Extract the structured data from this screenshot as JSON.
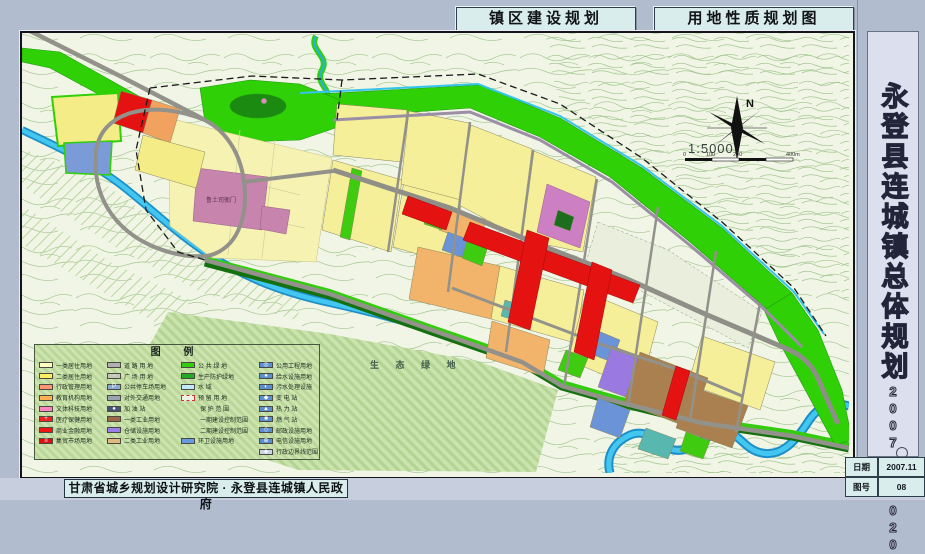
{
  "titles": {
    "left": "镇区建设规划",
    "right": "用地性质规划图"
  },
  "sidebar": {
    "title": "永登县连城镇总体规划",
    "period": "2007——2020"
  },
  "footer": {
    "credit": "甘肃省城乡规划设计研究院 · 永登县连城镇人民政府",
    "date_label": "日期",
    "date_value": "2007.11",
    "sheet_label": "图号",
    "sheet_value": "08"
  },
  "map": {
    "eco_label": "生 态 绿 地",
    "heritage_label": "鲁土司衙门",
    "north_label": "N",
    "scale_label": "1:5000",
    "scale_tick_0": "0",
    "scale_tick_1": "100",
    "scale_tick_2": "200",
    "scale_tick_3": "400m"
  },
  "colors": {
    "page_bg": "#b2bccf",
    "panel_cyan": "#d9edec",
    "map_bg": "#f1f5e6",
    "green_open": "#2fd005",
    "water": "#43c7f0",
    "residential": "#f6ef9a",
    "commercial_red": "#e51212",
    "industry_brown": "#ab8050",
    "storage_purple": "#9a7ae0",
    "admin_orange": "#f2b36a",
    "heritage_pink": "#c784ad",
    "utility_blue": "#5b8fd0"
  },
  "legend": {
    "title": "图    例",
    "columns": [
      [
        {
          "label": "一类居住用地",
          "color": "#ffffc2"
        },
        {
          "label": "二类居住用地",
          "color": "#fdf060"
        },
        {
          "label": "行政管理用地",
          "color": "#ff9470"
        },
        {
          "label": "教育机构用地",
          "color": "#ffb055"
        },
        {
          "label": "文体科技用地",
          "color": "#ff85c0"
        },
        {
          "label": "医疗保健用地",
          "color": "#ee2020",
          "icon": "+"
        },
        {
          "label": "商业金融用地",
          "color": "#ee1515"
        },
        {
          "label": "集贸市场用地",
          "color": "#dd1111",
          "icon": "≡"
        }
      ],
      [
        {
          "label": "道 路 用 地",
          "color": "#b0b0b0"
        },
        {
          "label": "广 场 用 地",
          "color": "#c2cab6",
          "icon": "∙∙"
        },
        {
          "label": "公共停车场用地",
          "color": "#88aacc",
          "icon": "P"
        },
        {
          "label": "对外交通用地",
          "color": "#9aa4b0"
        },
        {
          "label": "加 油 站",
          "color": "#445577",
          "icon": "●"
        },
        {
          "label": "一类工业用地",
          "color": "#9a6a48"
        },
        {
          "label": "仓储设施用地",
          "color": "#9b7fe8"
        },
        {
          "label": "二类工业用地",
          "color": "#dfb97f"
        }
      ],
      [
        {
          "label": "公 共 绿 地",
          "color": "#33cc11"
        },
        {
          "label": "生产防护绿地",
          "color": "#22aa22"
        },
        {
          "label": "水    域",
          "color": "#bfe8f8",
          "icon": "~"
        },
        {
          "label": "预 留 用 地",
          "color": "#eef2e4",
          "border": "dashed"
        },
        {
          "label": "保 护 范 围",
          "line": "dashdot",
          "lineColor": "#cc2222"
        },
        {
          "label": "一期建设控制范围",
          "line": "dash",
          "lineColor": "#cc2222"
        },
        {
          "label": "二期建设控制范围",
          "line": "dash",
          "lineColor": "#2255cc"
        },
        {
          "label": "环卫设施用地",
          "color": "#6699dd"
        }
      ],
      [
        {
          "label": "公用工程用地",
          "color": "#5b8fd0",
          "icon": "◎"
        },
        {
          "label": "给水设施用地",
          "color": "#5b8fd0",
          "icon": "●"
        },
        {
          "label": "污水处理设施",
          "color": "#5b8fd0",
          "icon": "◐"
        },
        {
          "label": "变 电 站",
          "color": "#5b8fd0",
          "icon": "◆"
        },
        {
          "label": "热 力 站",
          "color": "#5b8fd0",
          "icon": "▲"
        },
        {
          "label": "燃 气 站",
          "color": "#5b8fd0",
          "icon": "■"
        },
        {
          "label": "邮政设施用地",
          "color": "#5b8fd0",
          "icon": "◇"
        },
        {
          "label": "电信设施用地",
          "color": "#5b8fd0",
          "icon": "⊕"
        },
        {
          "label": "行政边界线范围",
          "color": "#c8d4e4",
          "icon": "◈"
        }
      ]
    ]
  }
}
